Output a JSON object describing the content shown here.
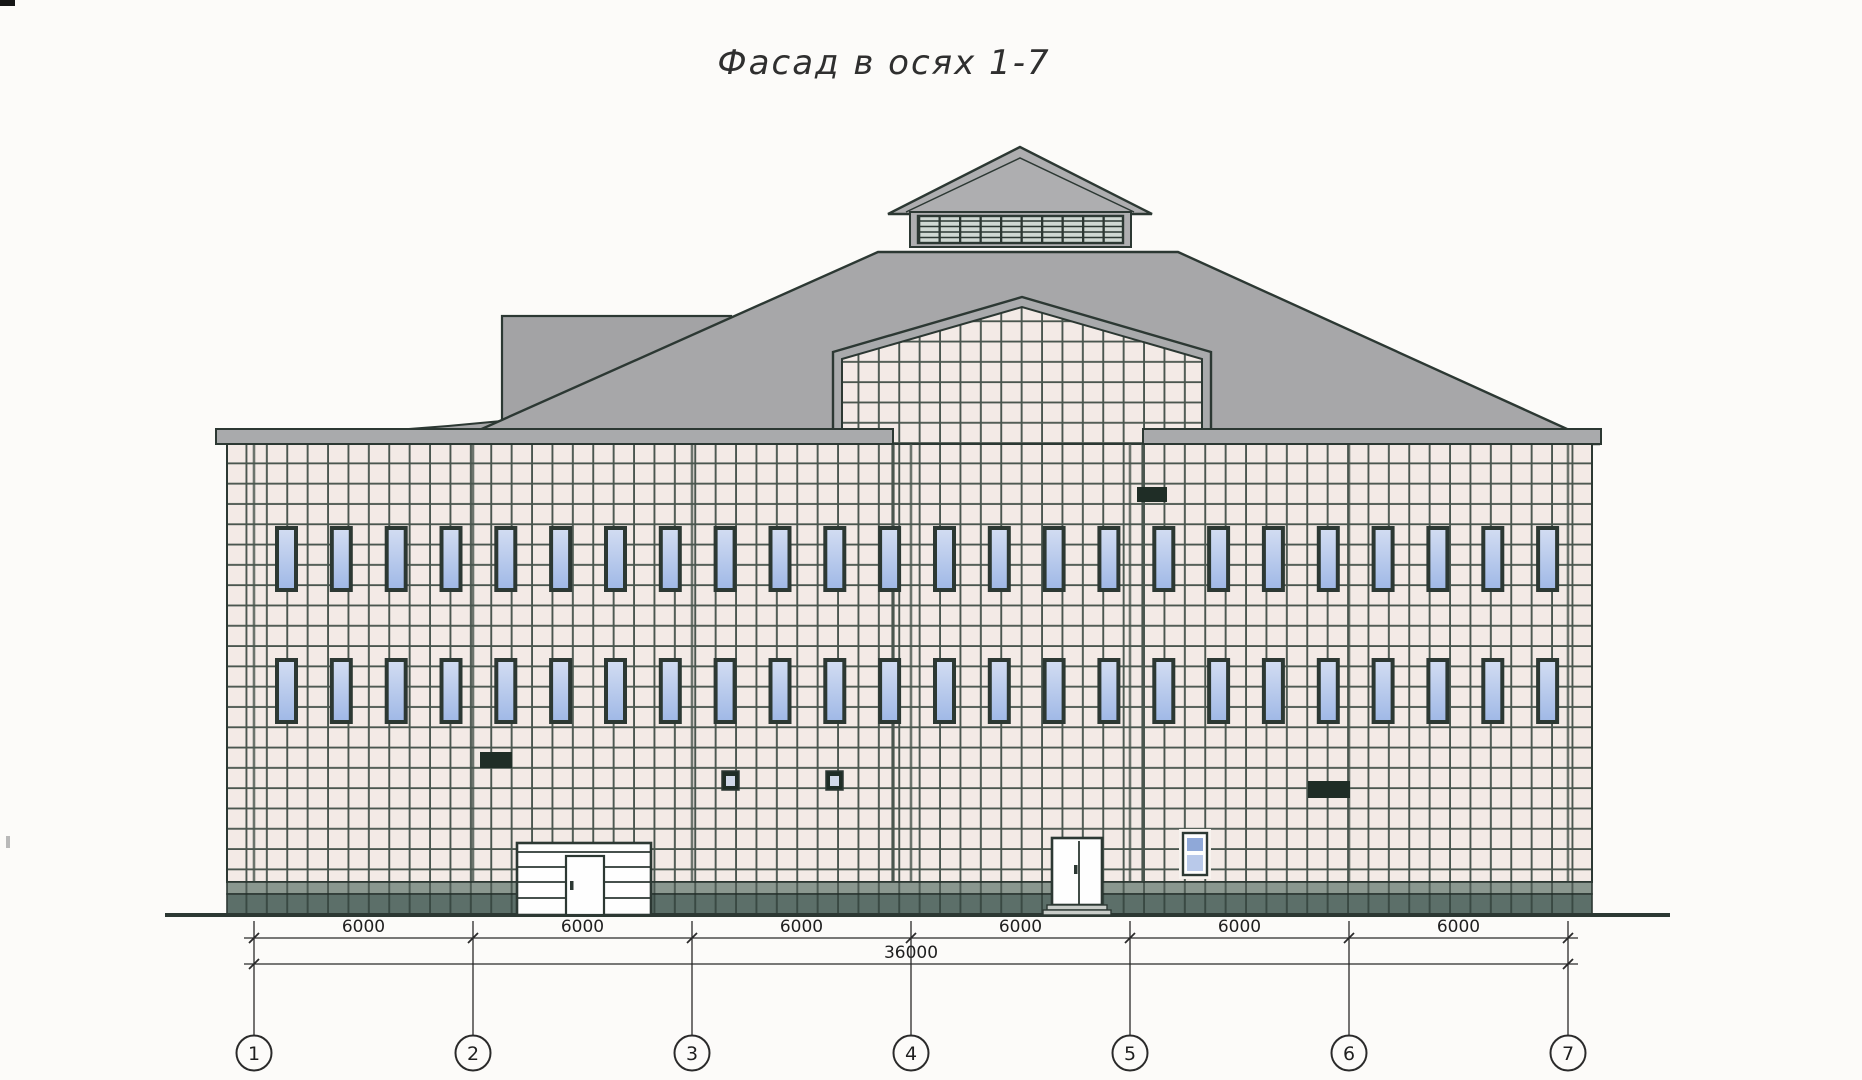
{
  "title": "Фасад в осях 1-7",
  "axes": {
    "labels": [
      "1",
      "2",
      "3",
      "4",
      "5",
      "6",
      "7"
    ]
  },
  "dimensions": {
    "bay_labels": [
      "6000",
      "6000",
      "6000",
      "6000",
      "6000",
      "6000"
    ],
    "total_label": "36000"
  },
  "colors": {
    "paper": "#fcfbf9",
    "line": "#2c3833",
    "roof": "#a7a7a9",
    "roof_light": "#aeaeb0",
    "penthouse": "#a3a3a5",
    "cornice": "#a9aaac",
    "tile": "#f3eae6",
    "grout": "#4a564f",
    "plinth_upper": "#8a978f",
    "plinth_lower": "#5c6f69",
    "glass_top": "#d3ddf2",
    "glass_bottom": "#9fb8e6",
    "window_frame": "#2c3833",
    "door": "#fefefe",
    "vent": "#1f2d26",
    "louver_bg": "#cfd8d3",
    "step": "#c9cdc9",
    "dim": "#2a2a2a"
  }
}
